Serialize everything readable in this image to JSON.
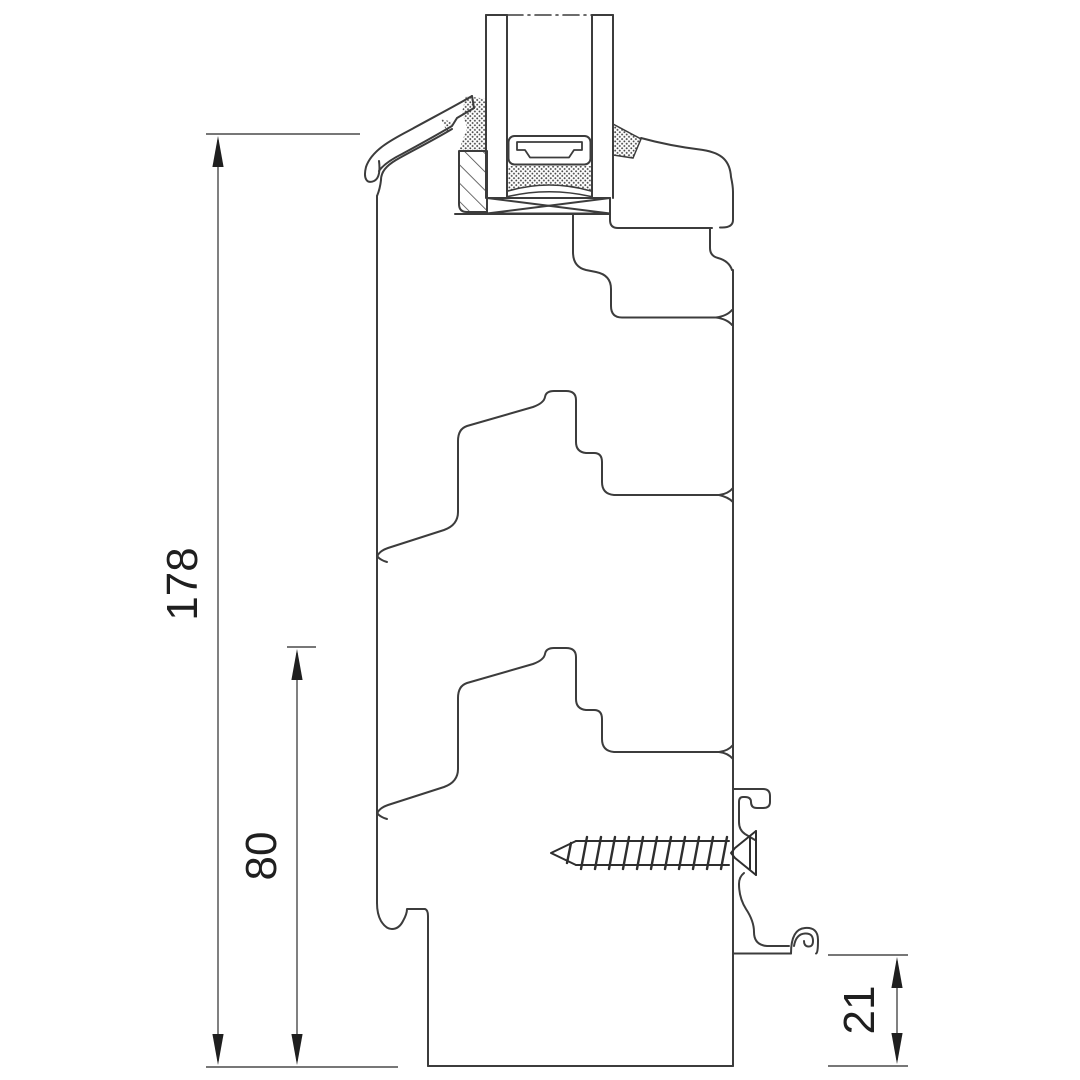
{
  "drawing": {
    "type": "window-frame-cross-section-technical-drawing",
    "background_color": "#ffffff",
    "line_color": "#3c3c3c",
    "dimension_line_color": "#4a4a4a",
    "text_color": "#1f1f1f",
    "dimensions": [
      {
        "id": "total-section-height",
        "label": "178"
      },
      {
        "id": "frame-extension-height",
        "label": "80"
      },
      {
        "id": "sill-clip-height",
        "label": "21"
      }
    ],
    "components": [
      "insulated-double-glazing",
      "glazing-spacer-with-desiccant",
      "setting-block",
      "glazing-bead-wood-hatched",
      "aluminium-drip-cap",
      "sealant-stipple",
      "sash-profile",
      "frame-profile",
      "frame-extension-profiles",
      "aluminium-sill-clip",
      "wood-screw"
    ]
  }
}
